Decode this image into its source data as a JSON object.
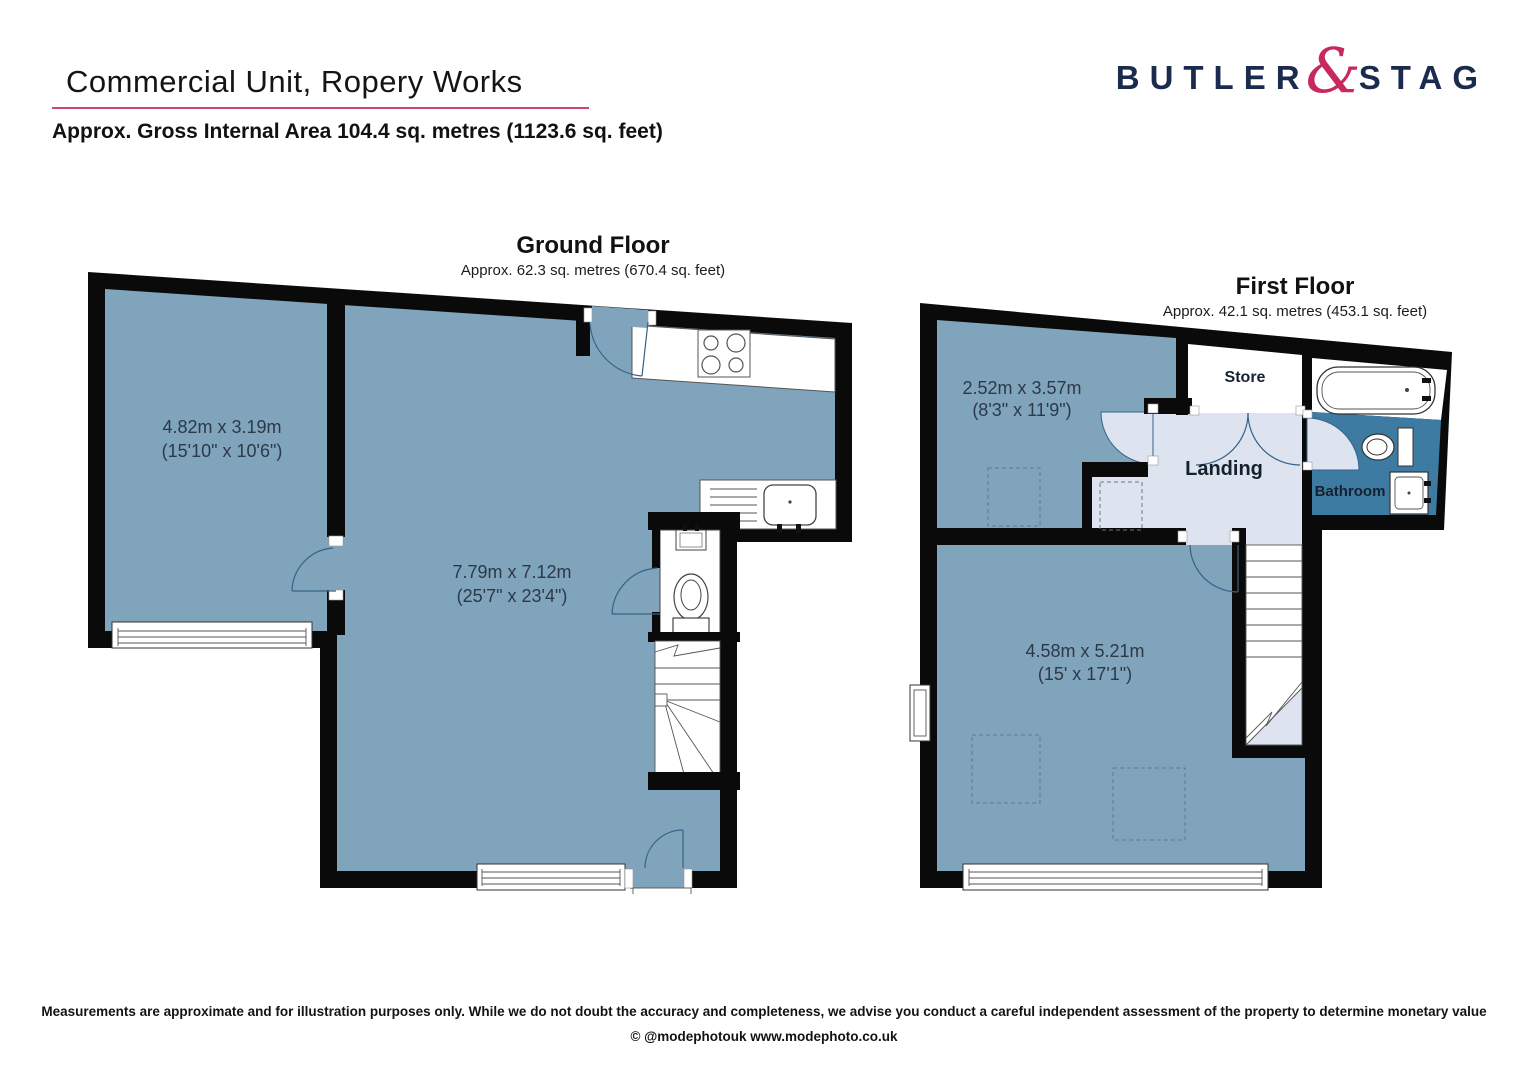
{
  "header": {
    "title": "Commercial Unit, Ropery Works",
    "subtitle": "Approx. Gross Internal Area 104.4 sq. metres (1123.6 sq. feet)"
  },
  "brand": {
    "left": "BUTLER",
    "ampersand": "&",
    "right": "STAG"
  },
  "colors": {
    "room_fill": "#7FA4BB",
    "landing_fill": "#DDE4EF",
    "bathroom_fill": "#3E7BA3",
    "wall": "#0A0A0A",
    "brand_navy": "#1B2B4D",
    "brand_pink": "#C7285F",
    "title_underline": "#C9486C"
  },
  "ground_floor": {
    "name": "Ground Floor",
    "area": "Approx. 62.3 sq. metres (670.4 sq. feet)",
    "rooms": [
      {
        "dim_metric": "4.82m x 3.19m",
        "dim_imperial": "(15'10\" x 10'6\")"
      },
      {
        "dim_metric": "7.79m x 7.12m",
        "dim_imperial": "(25'7\" x 23'4\")"
      }
    ],
    "fixtures": [
      "hob-icon",
      "sink-icon",
      "wc-toilet-icon",
      "wc-basin-icon",
      "stairs-up"
    ]
  },
  "first_floor": {
    "name": "First Floor",
    "area": "Approx. 42.1 sq. metres (453.1 sq. feet)",
    "rooms": [
      {
        "dim_metric": "2.52m x 3.57m",
        "dim_imperial": "(8'3\" x 11'9\")"
      },
      {
        "dim_metric": "4.58m x 5.21m",
        "dim_imperial": "(15' x 17'1\")"
      }
    ],
    "labels": {
      "store": "Store",
      "landing": "Landing",
      "bathroom": "Bathroom"
    },
    "fixtures": [
      "bath-icon",
      "toilet-icon",
      "basin-icon",
      "stairs-down",
      "roof-lights"
    ]
  },
  "footer": {
    "disclaimer": "Measurements are approximate and for illustration purposes only. While we do not doubt the accuracy and completeness, we advise you conduct a careful independent assessment of the property to determine monetary value",
    "credit": "© @modephotouk www.modephoto.co.uk"
  }
}
